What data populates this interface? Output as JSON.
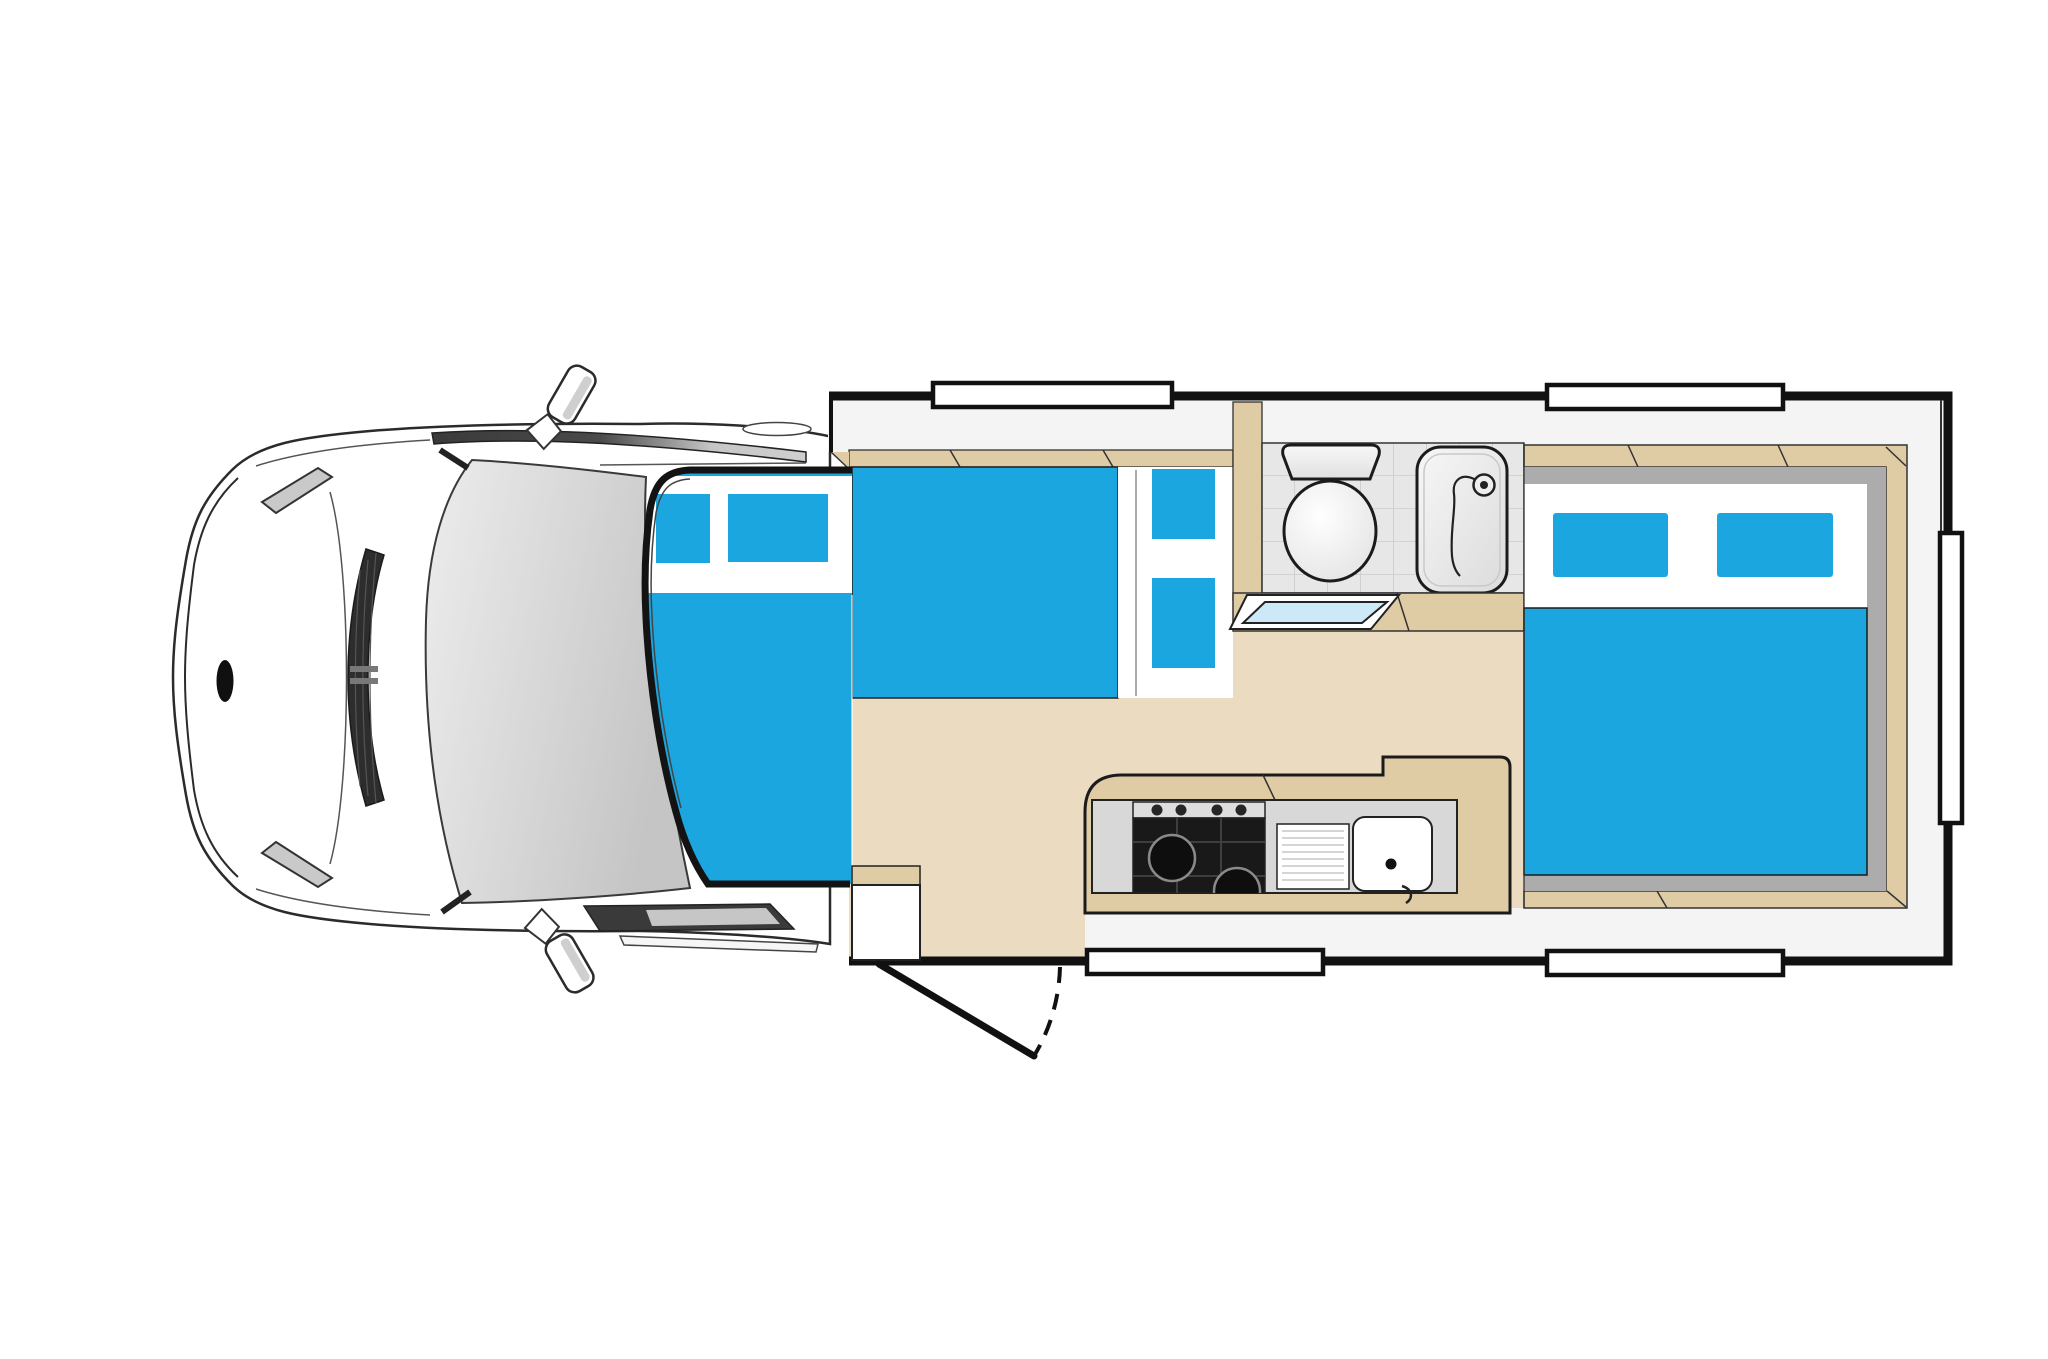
{
  "diagram": {
    "type": "motorhome-floor-plan",
    "view": "top-down",
    "cab": {
      "mirror_count": 2,
      "windshield": true,
      "grille": true
    },
    "overcab_bed": {
      "window_count": 2
    },
    "dinette": {
      "bench_seat_count": 1,
      "cushion_seat_count": 2,
      "has_table": true
    },
    "bathroom": {
      "has_toilet": true,
      "has_shower": true,
      "has_vanity_basin": true,
      "tiled_floor": true
    },
    "kitchen": {
      "stove_knob_count": 4,
      "burner_count": 2,
      "has_sink": true,
      "has_drainboard": true
    },
    "rear_bed": {
      "pillow_count": 2
    },
    "entry_door": {
      "swing_shown_dashed": true,
      "has_entry_step": true
    },
    "wall_windows": {
      "top_wall": 2,
      "bottom_wall": 2,
      "right_wall": 1
    }
  },
  "colors": {
    "upholstery": "#1CA6E0",
    "floor": "#EBDCC1",
    "bench": "#DFCBA4",
    "wall_band": "#F4F4F4",
    "white": "#FFFFFF",
    "tile": "#E7E7E7",
    "tile_line": "#CBCBCB",
    "bed_trim_gray": "#ACACAC",
    "counter_gray": "#D8D8D8",
    "hob_black": "#191919",
    "knob_strip": "#DEDEDE",
    "basin_blue": "#CDE8F6",
    "windshield_gray": "#D6D6D6",
    "outline": "#131313",
    "cab_band_dark": "#3A3A3A"
  }
}
